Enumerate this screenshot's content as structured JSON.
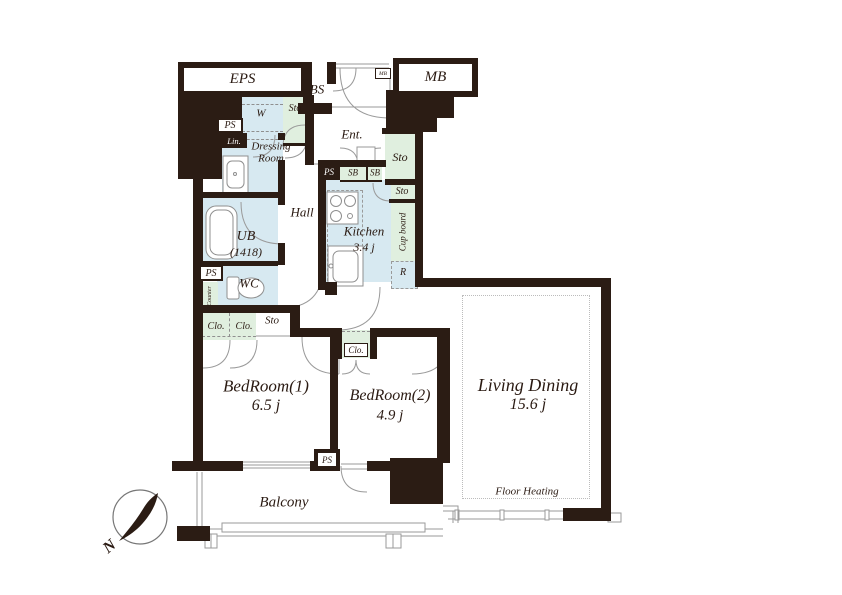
{
  "plan": {
    "rooms": {
      "eps": "EPS",
      "bs": "BS",
      "mb": "MB",
      "mb_meter": "MB",
      "washer": "W",
      "sto_top": "Sto",
      "ps_top": "PS",
      "linen": "Lin.",
      "dressing_line1": "Dressing",
      "dressing_line2": "Room",
      "hall": "Hall",
      "ub_line1": "UB",
      "ub_line2": "(1418)",
      "entrance": "Ent.",
      "ps_kitchen": "PS",
      "shoe_box_1": "SB",
      "shoe_box_2": "SB",
      "sto_entrance": "Sto",
      "sto_kitchen": "Sto",
      "cupboard": "Cup board",
      "kitchen_line1": "Kitchen",
      "kitchen_line2": "3.4 j",
      "refrigerator": "R",
      "ps_wc": "PS",
      "counter": "Counter",
      "wc": "WC",
      "sto_hall": "Sto",
      "closet_1": "Clo.",
      "closet_2": "Clo.",
      "closet_bed2": "Clo.",
      "bedroom1_line1": "BedRoom(1)",
      "bedroom1_line2": "6.5 j",
      "bedroom2_line1": "BedRoom(2)",
      "bedroom2_line2": "4.9 j",
      "living_dining_line1": "Living Dining",
      "living_dining_line2": "15.6 j",
      "floor_heating": "Floor Heating",
      "balcony": "Balcony",
      "ps_balcony": "PS"
    },
    "compass": {
      "north_label": "N"
    },
    "colors": {
      "wall": "#2b1c14",
      "wet_area": "#d7e9f1",
      "storage": "#e0efdf",
      "outline": "#9a9a9a",
      "text": "#2a1a12"
    }
  }
}
